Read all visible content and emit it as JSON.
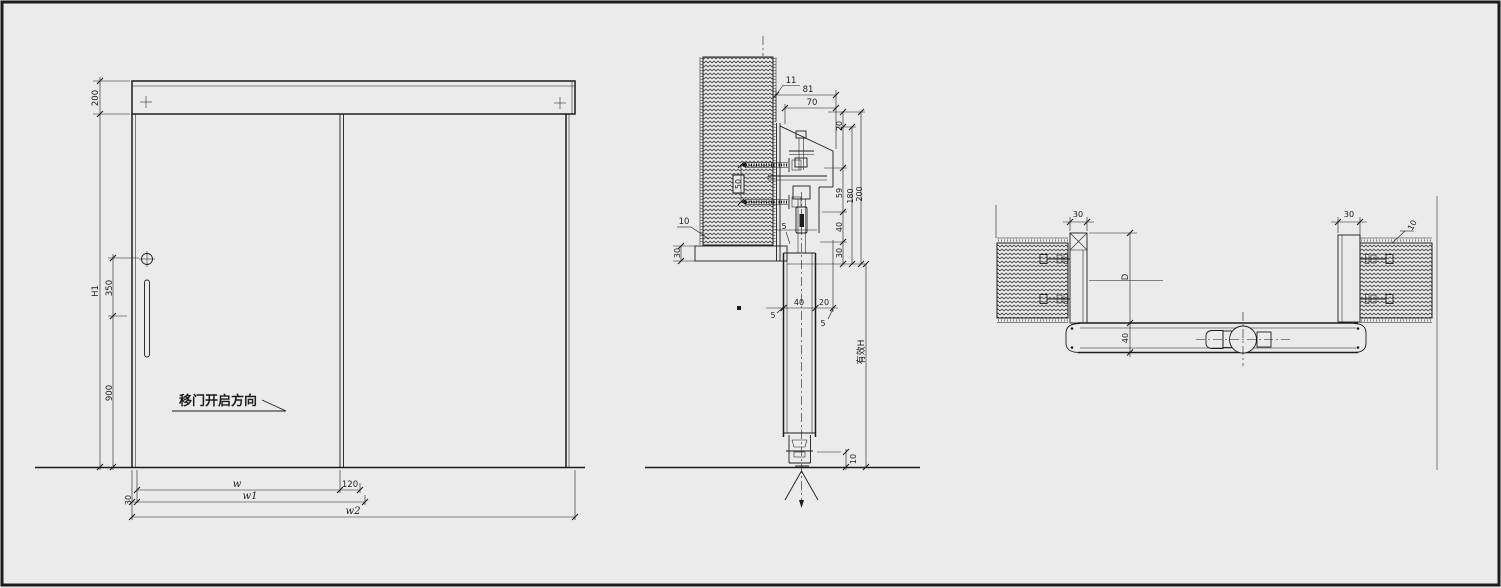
{
  "drawing": {
    "title": "sliding-door-cad-detail",
    "background_color": "#ebebeb",
    "line_color": "#1c1c1c"
  },
  "elevation": {
    "dim_header_height": "200",
    "dim_total_height": "H1",
    "dim_handle_offset": "350",
    "dim_handle_bottom": "900",
    "open_direction_label": "移门开启方向",
    "dim_panel_width": "w",
    "dim_overlap": "120",
    "dim_frame_edge": "30",
    "dim_width_w1": "w1",
    "dim_width_w2": "w2"
  },
  "vertical_section": {
    "dim_11": "11",
    "dim_81": "81",
    "dim_70": "70",
    "dim_top_20": "20",
    "dim_anchor_50": "50",
    "dim_finish_10": "10",
    "dim_ceiling_30": "30",
    "dim_59": "59",
    "dim_180": "180",
    "dim_200": "200",
    "dim_mid_40": "40",
    "dim_mid_30": "30",
    "dim_door_40": "40",
    "dim_gap_20": "20",
    "dim_5_top": "5",
    "dim_5_left": "5",
    "dim_5_right": "5",
    "dim_floor_10": "10",
    "label_effective_height": "有效H"
  },
  "horizontal_section": {
    "dim_left_jamb_30": "30",
    "dim_opening_D": "D",
    "dim_door_40": "40",
    "dim_right_jamb_30": "30",
    "dim_finish_10": "10"
  }
}
